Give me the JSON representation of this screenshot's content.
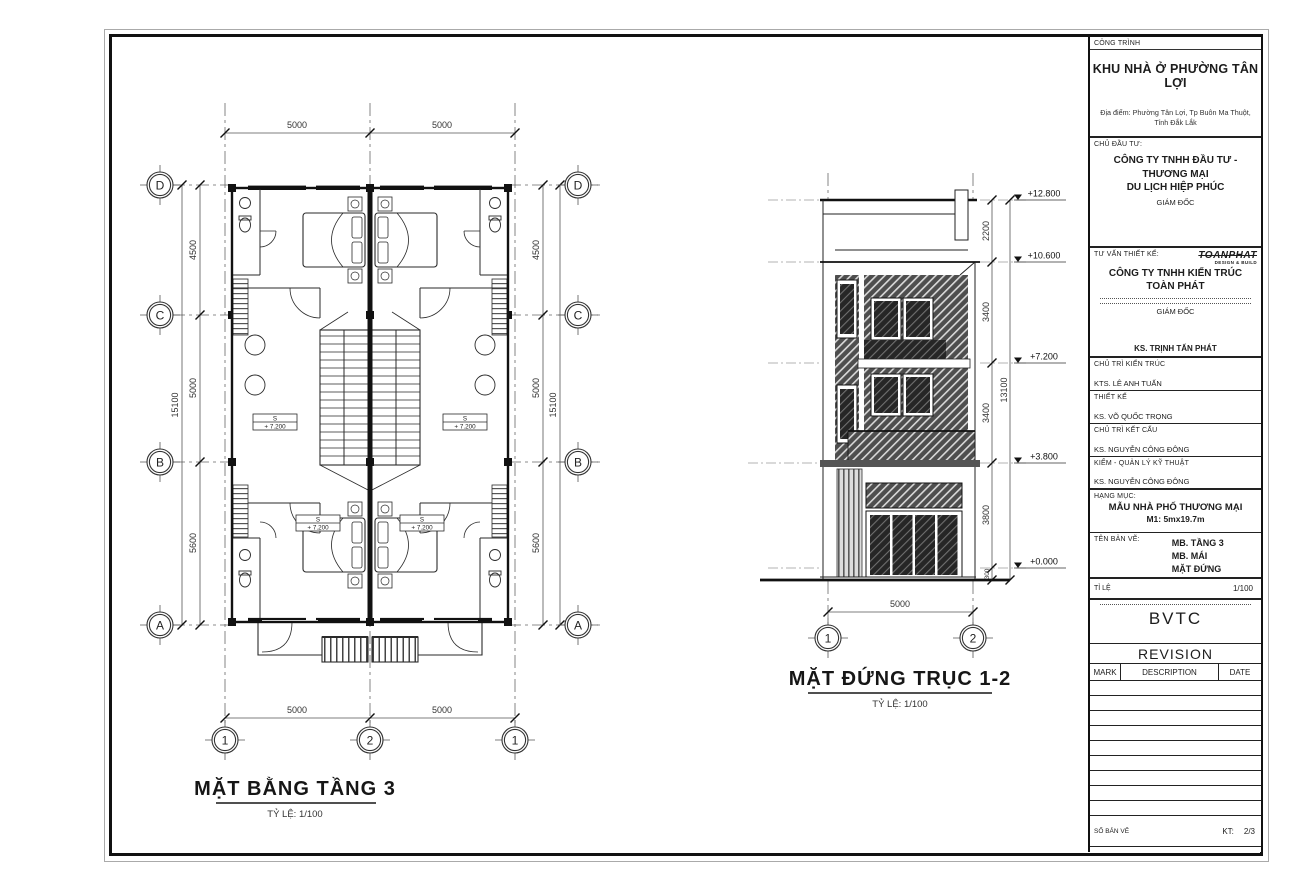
{
  "title_block": {
    "cong_trinh_label": "CÔNG TRÌNH",
    "project_name": "KHU NHÀ Ở PHƯỜNG TÂN LỢI",
    "address_line1": "Địa điểm: Phường Tân Lợi, Tp Buôn Ma Thuột,",
    "address_line2": "Tỉnh Đắk Lắk",
    "chu_dau_tu_label": "CHỦ ĐẦU TƯ:",
    "investor_line1": "CÔNG TY TNHH ĐẦU TƯ - THƯƠNG MẠI",
    "investor_line2": "DU LỊCH HIỆP PHÚC",
    "giam_doc_label": "GIÁM ĐỐC",
    "tu_van_label": "TƯ VẤN THIẾT KẾ:",
    "logo_text": "TOANPHAT",
    "logo_sub": "DESIGN & BUILD",
    "consultant_line1": "CÔNG TY TNHH KIẾN TRÚC",
    "consultant_line2": "TOÀN PHÁT",
    "giam_doc2_label": "GIÁM ĐỐC",
    "director_name": "KS. TRỊNH TẤN PHÁT",
    "roles": [
      {
        "label": "CHỦ TRÌ KIẾN TRÚC",
        "name": "KTS. LÊ ANH TUẤN"
      },
      {
        "label": "THIẾT KẾ",
        "name": "KS. VÕ QUỐC TRỌNG"
      },
      {
        "label": "CHỦ TRÌ KẾT CẤU",
        "name": "KS. NGUYỄN CÔNG ĐÔNG"
      },
      {
        "label": "KIỂM - QUẢN LÝ KỸ THUẬT",
        "name": "KS. NGUYỄN CÔNG ĐÔNG"
      }
    ],
    "hang_muc_label": "HẠNG MỤC:",
    "category_line1": "MẪU NHÀ PHỐ THƯƠNG MẠI",
    "category_line2": "M1: 5mx19.7m",
    "ten_ban_ve_label": "TÊN BẢN VẼ:",
    "sheet_names": [
      "MB. TẦNG 3",
      "MB. MÁI",
      "MẶT ĐỨNG"
    ],
    "ti_le_label": "TỈ LỆ",
    "scale_value": "1/100",
    "bvtc": "BVTC",
    "revision": "REVISION",
    "rev_cols": [
      "MARK",
      "DESCRIPTION",
      "DATE"
    ],
    "so_ban_ve_label": "SỐ BẢN VẼ",
    "kt_label": "KT:",
    "sheet_number": "2/3"
  },
  "floor_plan": {
    "title": "MẶT BẰNG TẦNG 3",
    "scale": "TỶ LỆ: 1/100",
    "room_label": "S",
    "room_level": "+ 7.200",
    "grid_rows": [
      "D",
      "C",
      "B",
      "A"
    ],
    "grid_cols": [
      "1",
      "2",
      "1"
    ],
    "dims_top": [
      "5000",
      "5000"
    ],
    "dims_bottom": [
      "5000",
      "5000"
    ],
    "dims_left": [
      "4500",
      "5000",
      "5600"
    ],
    "dims_left_total": "15100",
    "dims_right": [
      "4500",
      "5000",
      "5600"
    ],
    "dims_right_total": "15100"
  },
  "elevation": {
    "title": "MẶT ĐỨNG TRỤC 1-2",
    "scale": "TỶ LỆ: 1/100",
    "levels": [
      "+12.800",
      "+10.600",
      "+7.200",
      "+3.800",
      "+0.000"
    ],
    "segments": [
      "2200",
      "3400",
      "3400",
      "3800",
      "300"
    ],
    "total": "13100",
    "dim_bottom": "5000",
    "grid_cols": [
      "1",
      "2"
    ]
  }
}
